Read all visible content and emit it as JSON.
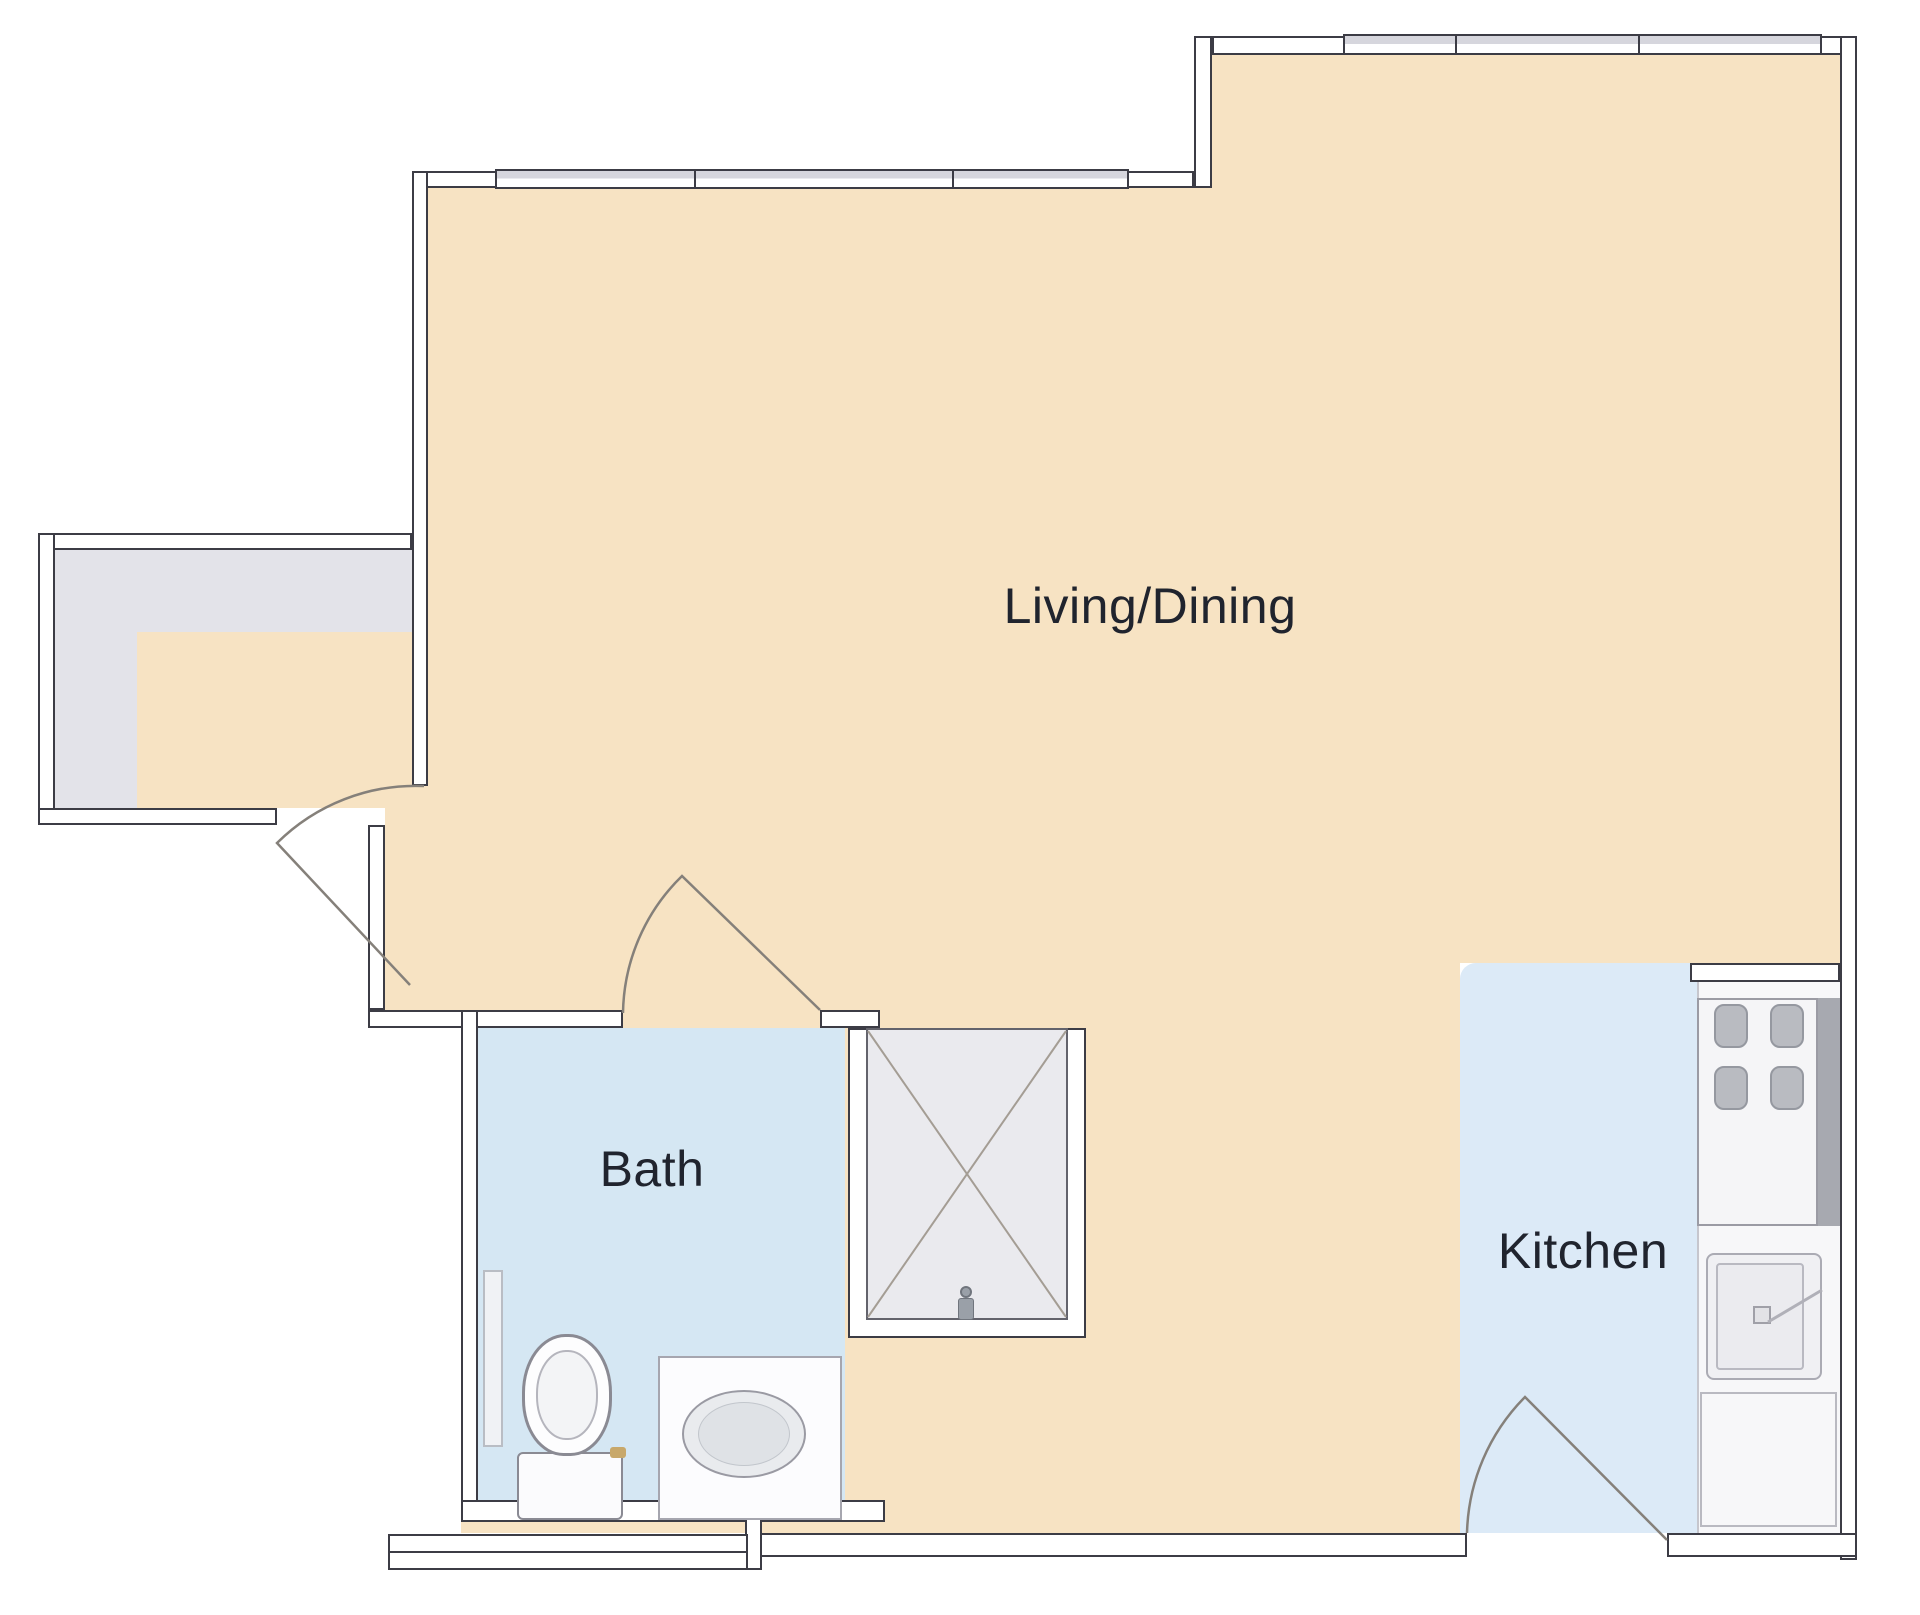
{
  "plan": {
    "type": "apartment-floor-plan",
    "rooms": {
      "living_dining": {
        "label": "Living/Dining",
        "floor_color": "#f7e3c3"
      },
      "bath": {
        "label": "Bath",
        "floor_color": "#d5e7f3"
      },
      "kitchen": {
        "label": "Kitchen",
        "floor_color": "#dceaf7"
      },
      "entry": {
        "label": "",
        "floor_color": "#e3e3e9"
      }
    },
    "palette": {
      "wall_fill": "#ffffff",
      "wall_outline": "#3c3c45",
      "window_glass": "#d6d6dd",
      "shower_pan": "#eaeaee",
      "shower_line": "#a49d94",
      "door_arc": "#85807a",
      "appliance_gray": "#a7a9b0",
      "burner_gray": "#b9bbc1",
      "text_color": "#20242e"
    },
    "fixtures": [
      "toilet",
      "vanity-sink",
      "shower",
      "stove",
      "kitchen-sink",
      "refrigerator"
    ]
  }
}
